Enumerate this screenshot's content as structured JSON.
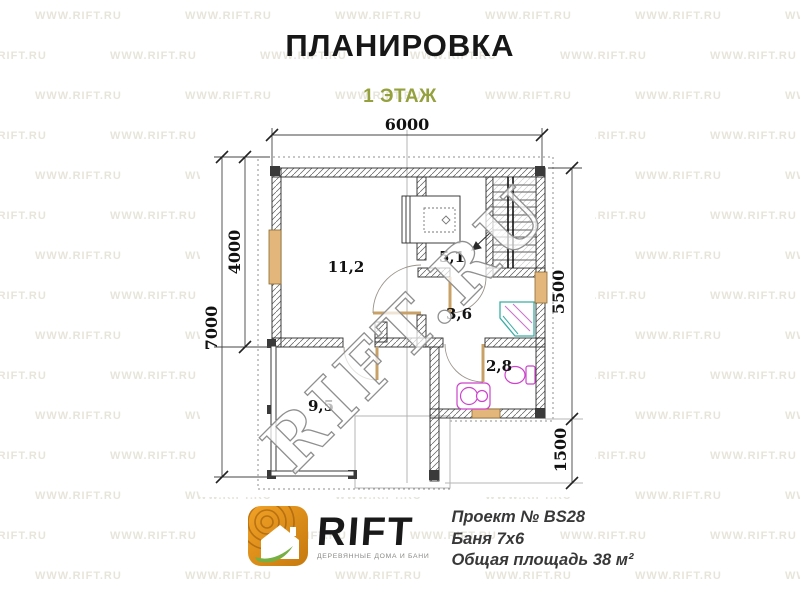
{
  "title": "ПЛАНИРОВКА",
  "floor_label": "1 ЭТАЖ",
  "colors": {
    "accent_green": "#94a13e",
    "logo_orange": "#e8921a",
    "leaf_green": "#76b043",
    "window_tan": "#e3b67c",
    "sanitary_magenta": "#cc44cc",
    "shower_teal": "#3aada5",
    "watermark_gray": "#d9d6c4"
  },
  "dimensions": {
    "top": "6000",
    "left_inner": "4000",
    "left_outer": "7000",
    "right_upper": "5500",
    "right_lower": "1500"
  },
  "rooms": [
    {
      "id": "room-rest",
      "area": "11,2"
    },
    {
      "id": "room-sauna",
      "area": "5,1"
    },
    {
      "id": "room-washing",
      "area": "3,6"
    },
    {
      "id": "room-wc",
      "area": "2,8"
    },
    {
      "id": "room-terrace",
      "area": "9,5"
    }
  ],
  "watermark": {
    "diagonal": "RIFT.RU",
    "tile": "WWW.RIFT.RU"
  },
  "logo": {
    "name": "RIFT",
    "tagline": "ДЕРЕВЯННЫЕ ДОМА И БАНИ"
  },
  "project": {
    "line1": "Проект № BS28",
    "line2": "Баня 7х6",
    "line3": "Общая площадь 38 м²"
  }
}
